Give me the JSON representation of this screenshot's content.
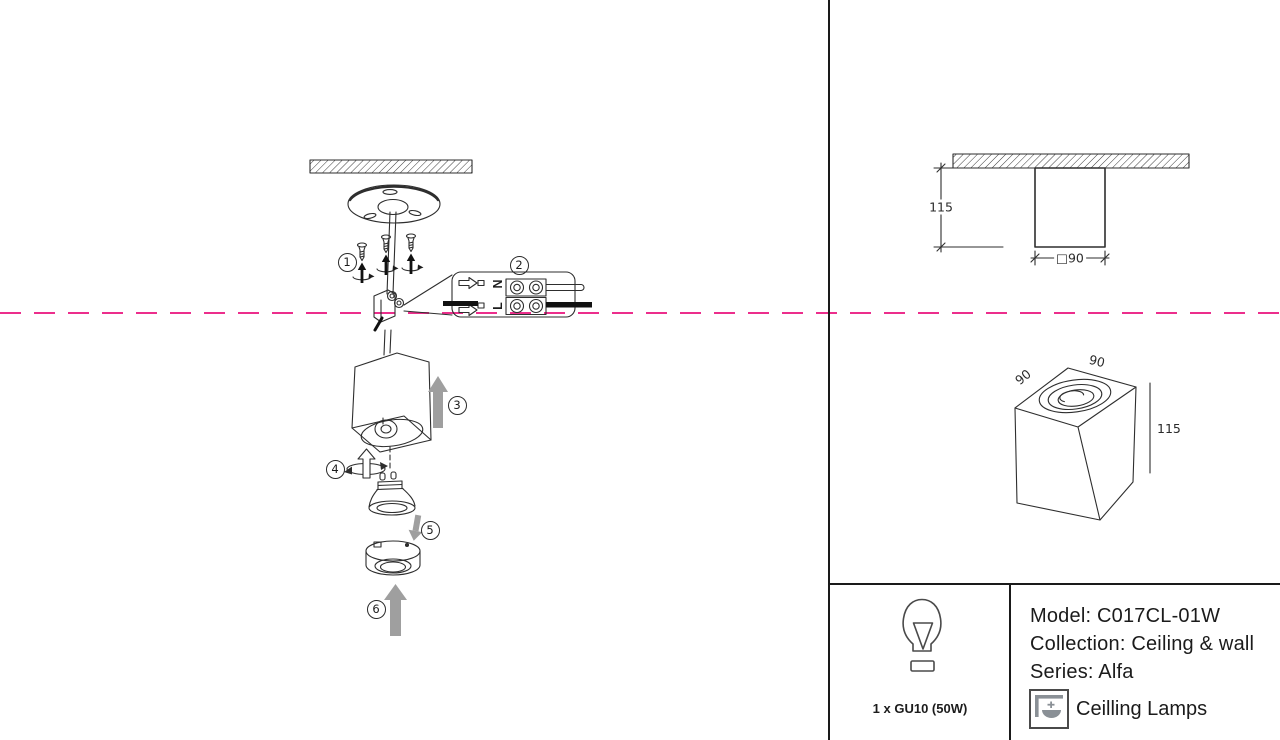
{
  "colors": {
    "accent_datum": "#EC2E8C",
    "ink": "#2e2e2e",
    "arrow_gray": "#9f9f9f",
    "icon_gray": "#8a9096"
  },
  "assembly": {
    "steps": [
      {
        "num": "1"
      },
      {
        "num": "2"
      },
      {
        "num": "3"
      },
      {
        "num": "4"
      },
      {
        "num": "5"
      },
      {
        "num": "6"
      }
    ],
    "terminal": {
      "neutral_label": "N",
      "live_label": "L"
    }
  },
  "side_view": {
    "height_label": "115",
    "width_label": "□90"
  },
  "iso_view": {
    "depth_label": "90",
    "width_label": "90",
    "height_label": "115"
  },
  "spec": {
    "bulb_label": "1 x GU10 (50W)",
    "model_line": "Model: C017CL-01W",
    "collection_line": "Collection: Ceiling & wall",
    "series_line": "Series: Alfa",
    "category_label": "Ceilling Lamps"
  }
}
